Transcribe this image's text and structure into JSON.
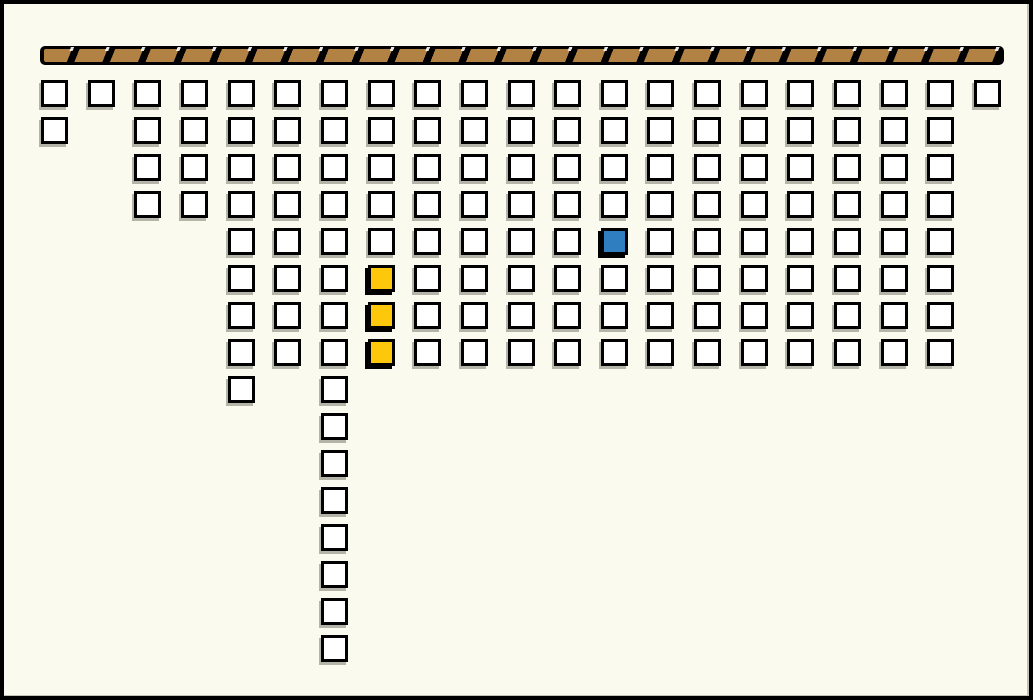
{
  "window": {
    "width": 1033,
    "height": 700,
    "background": "#FBFAEE",
    "frame_color": "#000000"
  },
  "beam": {
    "x": 36,
    "y": 42,
    "width": 964,
    "height": 19,
    "fill": "#B28144",
    "divider_color": "#000000",
    "tick_color": "#FFFFFF",
    "segment_pitch_px": 33,
    "divider_width_px": 7
  },
  "grid": {
    "origin_x": 37,
    "origin_y": 76,
    "pitch_x": 46.65,
    "pitch_y": 37,
    "cell_size": 27,
    "columns": 21,
    "rows": 16,
    "border_color": "#000000",
    "default_fill": "#FFFFFF"
  },
  "block_colors": {
    "white": "#FFFFFF",
    "yellow": "#FDC70C",
    "blue": "#2F7FC0"
  },
  "occupancy": [
    {
      "row": 0,
      "cols": [
        0,
        1,
        2,
        3,
        4,
        5,
        6,
        7,
        8,
        9,
        10,
        11,
        12,
        13,
        14,
        15,
        16,
        17,
        18,
        19,
        20
      ]
    },
    {
      "row": 1,
      "cols": [
        0,
        2,
        3,
        4,
        5,
        6,
        7,
        8,
        9,
        10,
        11,
        12,
        13,
        14,
        15,
        16,
        17,
        18,
        19
      ]
    },
    {
      "row": 2,
      "cols": [
        2,
        3,
        4,
        5,
        6,
        7,
        8,
        9,
        10,
        11,
        12,
        13,
        14,
        15,
        16,
        17,
        18,
        19
      ]
    },
    {
      "row": 3,
      "cols": [
        2,
        3,
        4,
        5,
        6,
        7,
        8,
        9,
        10,
        11,
        12,
        13,
        14,
        15,
        16,
        17,
        18,
        19
      ]
    },
    {
      "row": 4,
      "cols": [
        4,
        5,
        6,
        7,
        8,
        9,
        10,
        11,
        12,
        13,
        14,
        15,
        16,
        17,
        18,
        19
      ]
    },
    {
      "row": 5,
      "cols": [
        4,
        5,
        6,
        7,
        8,
        9,
        10,
        11,
        12,
        13,
        14,
        15,
        16,
        17,
        18,
        19
      ]
    },
    {
      "row": 6,
      "cols": [
        4,
        5,
        6,
        7,
        8,
        9,
        10,
        11,
        12,
        13,
        14,
        15,
        16,
        17,
        18,
        19
      ]
    },
    {
      "row": 7,
      "cols": [
        4,
        5,
        6,
        7,
        8,
        9,
        10,
        11,
        12,
        13,
        14,
        15,
        16,
        17,
        18,
        19
      ]
    },
    {
      "row": 8,
      "cols": [
        4,
        6
      ]
    },
    {
      "row": 9,
      "cols": [
        6
      ]
    },
    {
      "row": 10,
      "cols": [
        6
      ]
    },
    {
      "row": 11,
      "cols": [
        6
      ]
    },
    {
      "row": 12,
      "cols": [
        6
      ]
    },
    {
      "row": 13,
      "cols": [
        6
      ]
    },
    {
      "row": 14,
      "cols": [
        6
      ]
    },
    {
      "row": 15,
      "cols": [
        6
      ]
    }
  ],
  "colored_blocks": [
    {
      "row": 4,
      "col": 12,
      "color": "blue"
    },
    {
      "row": 5,
      "col": 7,
      "color": "yellow"
    },
    {
      "row": 6,
      "col": 7,
      "color": "yellow"
    },
    {
      "row": 7,
      "col": 7,
      "color": "yellow"
    }
  ]
}
